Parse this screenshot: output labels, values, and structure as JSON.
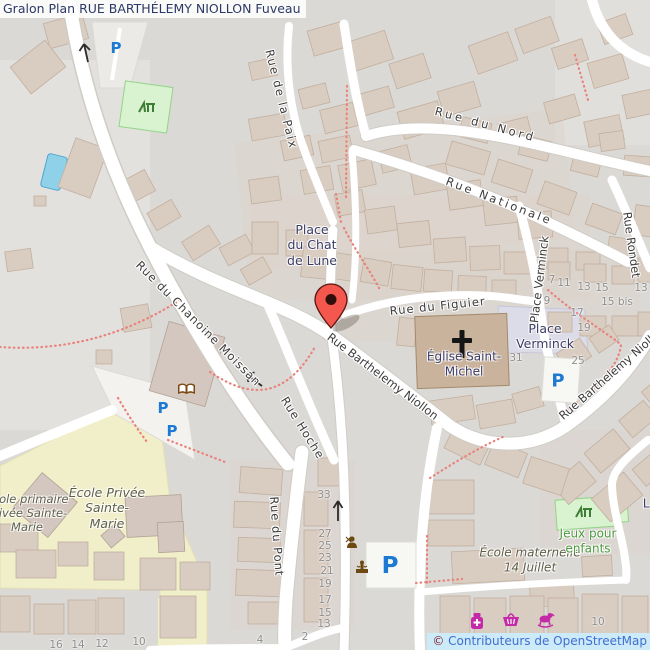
{
  "title": "Gralon Plan RUE BARTHÉLEMY NIOLLON Fuveau",
  "attribution": {
    "symbol": "©",
    "text": " Contributeurs de OpenStreetMap"
  },
  "streets": {
    "paix": "Rue de la Paix",
    "nord": "Rue du Nord",
    "nationale": "Rue Nationale",
    "place_verminck_street": "Place Verminck",
    "rondet": "Rue Rondet",
    "figuier": "Rue du Figuier",
    "barthelemy_center": "Rue Barthelemy Niollon",
    "barthelemy_right": "Rue Barthelemy Niollon",
    "hoche": "Rue Hoche",
    "pont": "Rue du Pont",
    "moissan": "Rue du Chanoine Moissan"
  },
  "places": {
    "chat_de_lune": "Place\ndu Chat\nde Lune",
    "verminck": "Place\nVerminck",
    "eglise": "Église Saint-\nMichel",
    "ecole_privee": "École Privée\nSainte-\nMarie",
    "ecole_primaire": "École primaire\nprivée Sainte-\nMarie",
    "ecole_maternelle": "École maternelle\n14 Juillet",
    "jeux": "Jeux pour\nenfants",
    "partial_right": "La"
  },
  "labels": {
    "parking": "P"
  },
  "house_numbers": [
    "33",
    "27",
    "25",
    "23",
    "21",
    "19",
    "17",
    "15",
    "13",
    "4",
    "2",
    "16",
    "14",
    "12",
    "10",
    "7",
    "11",
    "13",
    "15",
    "13",
    "9",
    "15 bis",
    "17",
    "19",
    "31",
    "25",
    "10"
  ],
  "icons": {
    "marker": "map-pin",
    "church": "christian-cross",
    "library": "open-book",
    "playground": "playground",
    "hairdresser": "hairdresser",
    "fountain": "fountain",
    "pharmacy": "pharmacy-bottle",
    "supermarket": "shopping-basket",
    "toys": "rocking-horse",
    "parking": "P",
    "oneway": "arrow"
  },
  "colors": {
    "background": "#dbd9d6",
    "road": "#ffffff",
    "building": "#d9ccc1",
    "church": "#c9b39d",
    "school_area": "#f1efca",
    "pedestrian_square": "#dcdce8",
    "playground": "#d9f2cf",
    "water": "#8fd1e9",
    "marker_red": "#f4574d",
    "parking_blue": "#1d7ad2",
    "dashed_path": "#e8827a",
    "title_text": "#2c3966",
    "copyright_bg": "#cdeaf9"
  }
}
